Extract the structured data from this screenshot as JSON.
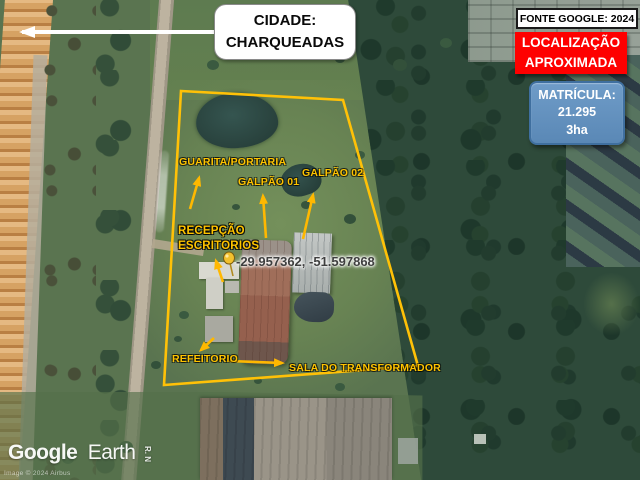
{
  "annotations": {
    "city_callout": {
      "title": "CIDADE:",
      "city": "CHARQUEADAS"
    },
    "source_label": "FONTE GOOGLE: 2024",
    "location_label": {
      "line1": "LOCALIZAÇÃO",
      "line2": "APROXIMADA"
    },
    "registry": {
      "title": "MATRÍCULA:",
      "number": "21.295",
      "area": "3ha"
    },
    "coordinates": "-29.957362, -51.597868",
    "sites": {
      "guarita": "GUARITA/PORTARIA",
      "galpao_01": "GALPÃO 01",
      "galpao_02": "GALPÃO 02",
      "recepcao": "RECEPÇÃO",
      "escritorios": "ESCRITORIOS",
      "refeitorio": "REFEITORIO",
      "sala_transformador": "SALA DO TRANSFORMADOR"
    },
    "street_label": "R. N"
  },
  "watermark": {
    "brand": "Google",
    "product": "Earth",
    "copyright": "Image © 2024 Airbus"
  },
  "colors": {
    "annotation_yellow": "#FFC107",
    "alert_red": "#FE0000",
    "registry_blue": "#5A88B6",
    "callout_white": "#FFFFFF"
  }
}
